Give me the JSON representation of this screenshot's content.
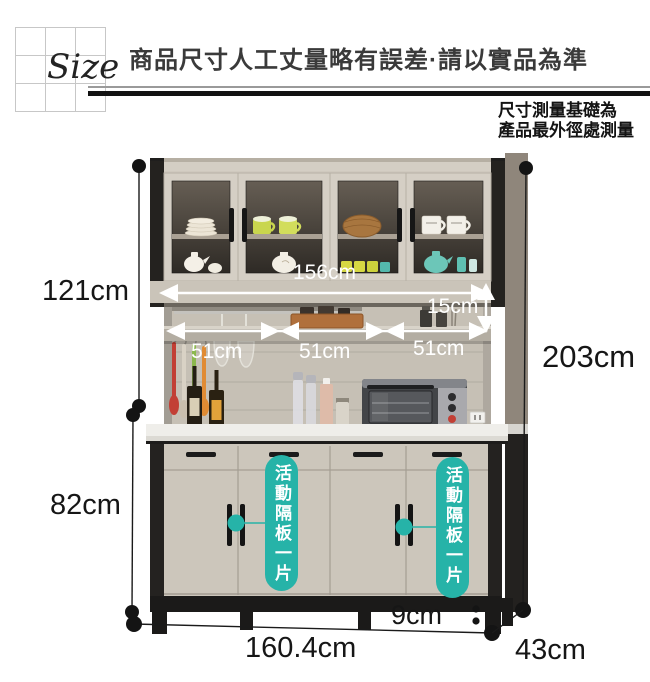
{
  "header": {
    "size_label": "Size",
    "title": "商品尺寸人工丈量略有誤差·請以實品為準",
    "note_line1": "尺寸測量基礎為",
    "note_line2": "產品最外徑處測量"
  },
  "dimensions": {
    "hutch_height": "121cm",
    "base_cabinet_height": "82cm",
    "total_height": "203cm",
    "leg_height": "9cm",
    "total_width": "160.4cm",
    "depth": "43cm",
    "inner_width": "156cm",
    "shelf_gap_height": "15cm",
    "section_width_1": "51cm",
    "section_width_2": "51cm",
    "section_width_3": "51cm"
  },
  "callouts": {
    "movable_shelf_left": "活動隔板一片",
    "movable_shelf_right": "活動隔板一片"
  },
  "colors": {
    "accent_teal": "#26b3a8",
    "dimension_line": "#161616",
    "arrow_white": "#ffffff",
    "wood_light": "#cfc9be",
    "frame_black": "#23211f"
  }
}
